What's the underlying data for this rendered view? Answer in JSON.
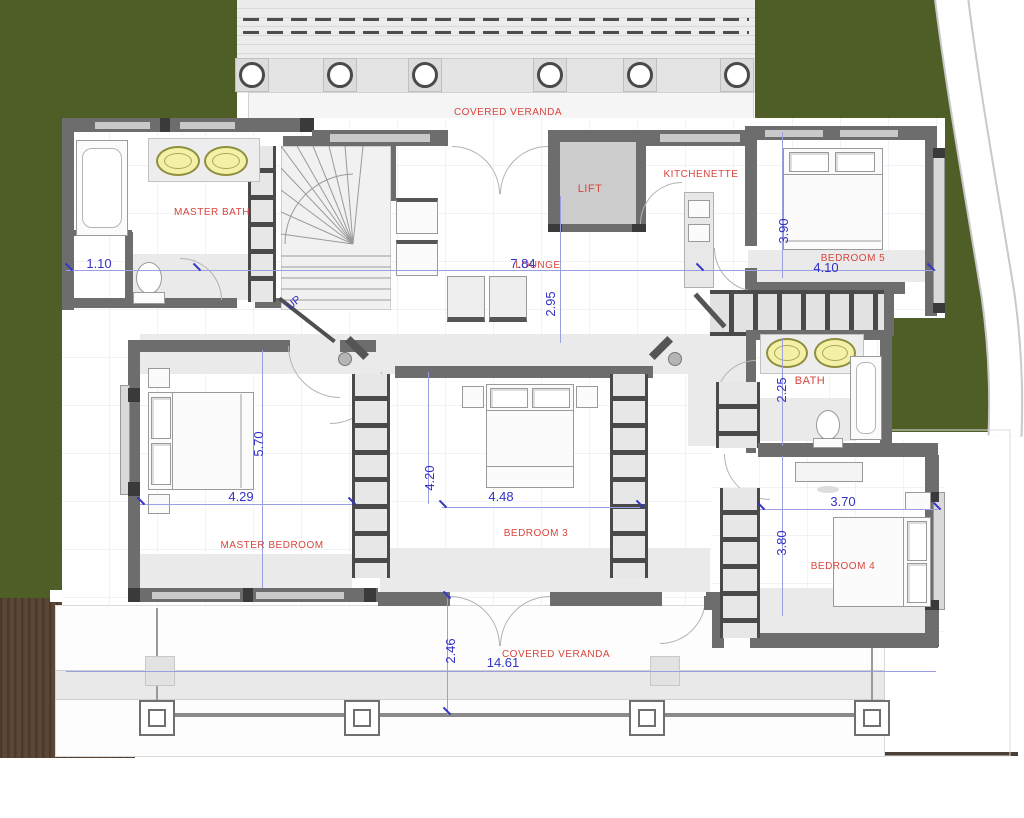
{
  "title": "First floor plan",
  "labels": {
    "veranda_top": "COVERED VERANDA",
    "master_bath": "MASTER BATH",
    "lift": "LIFT",
    "kitchenette": "KITCHENETTE",
    "bedroom5": "BEDROOM 5",
    "lounge": "LOUNGE",
    "bath": "BATH",
    "master_bedroom": "MASTER BEDROOM",
    "bedroom3": "BEDROOM 3",
    "bedroom4": "BEDROOM 4",
    "veranda_bottom": "COVERED VERANDA",
    "up": "UP"
  },
  "dimensions": {
    "closet_width": "1.10",
    "lounge_width": "7.84",
    "lounge_depth": "2.95",
    "bedroom5_depth": "3.90",
    "bedroom5_width": "4.10",
    "bath_depth": "2.25",
    "master_bedroom_depth": "5.70",
    "master_bedroom_width": "4.29",
    "bedroom3_depth": "4.20",
    "bedroom3_width": "4.48",
    "bedroom4_width": "3.70",
    "bedroom4_depth": "3.80",
    "veranda_bottom_depth": "2.46",
    "veranda_bottom_width": "14.61"
  },
  "colors": {
    "grass": "#4f5d27",
    "deck": "#5c4736",
    "deck_stripe": "#4b392c",
    "wall": "#6d6d6d",
    "room_label": "#d8453e",
    "dimension_text": "#3232c6",
    "dimension_line": "#9b9fe2"
  }
}
